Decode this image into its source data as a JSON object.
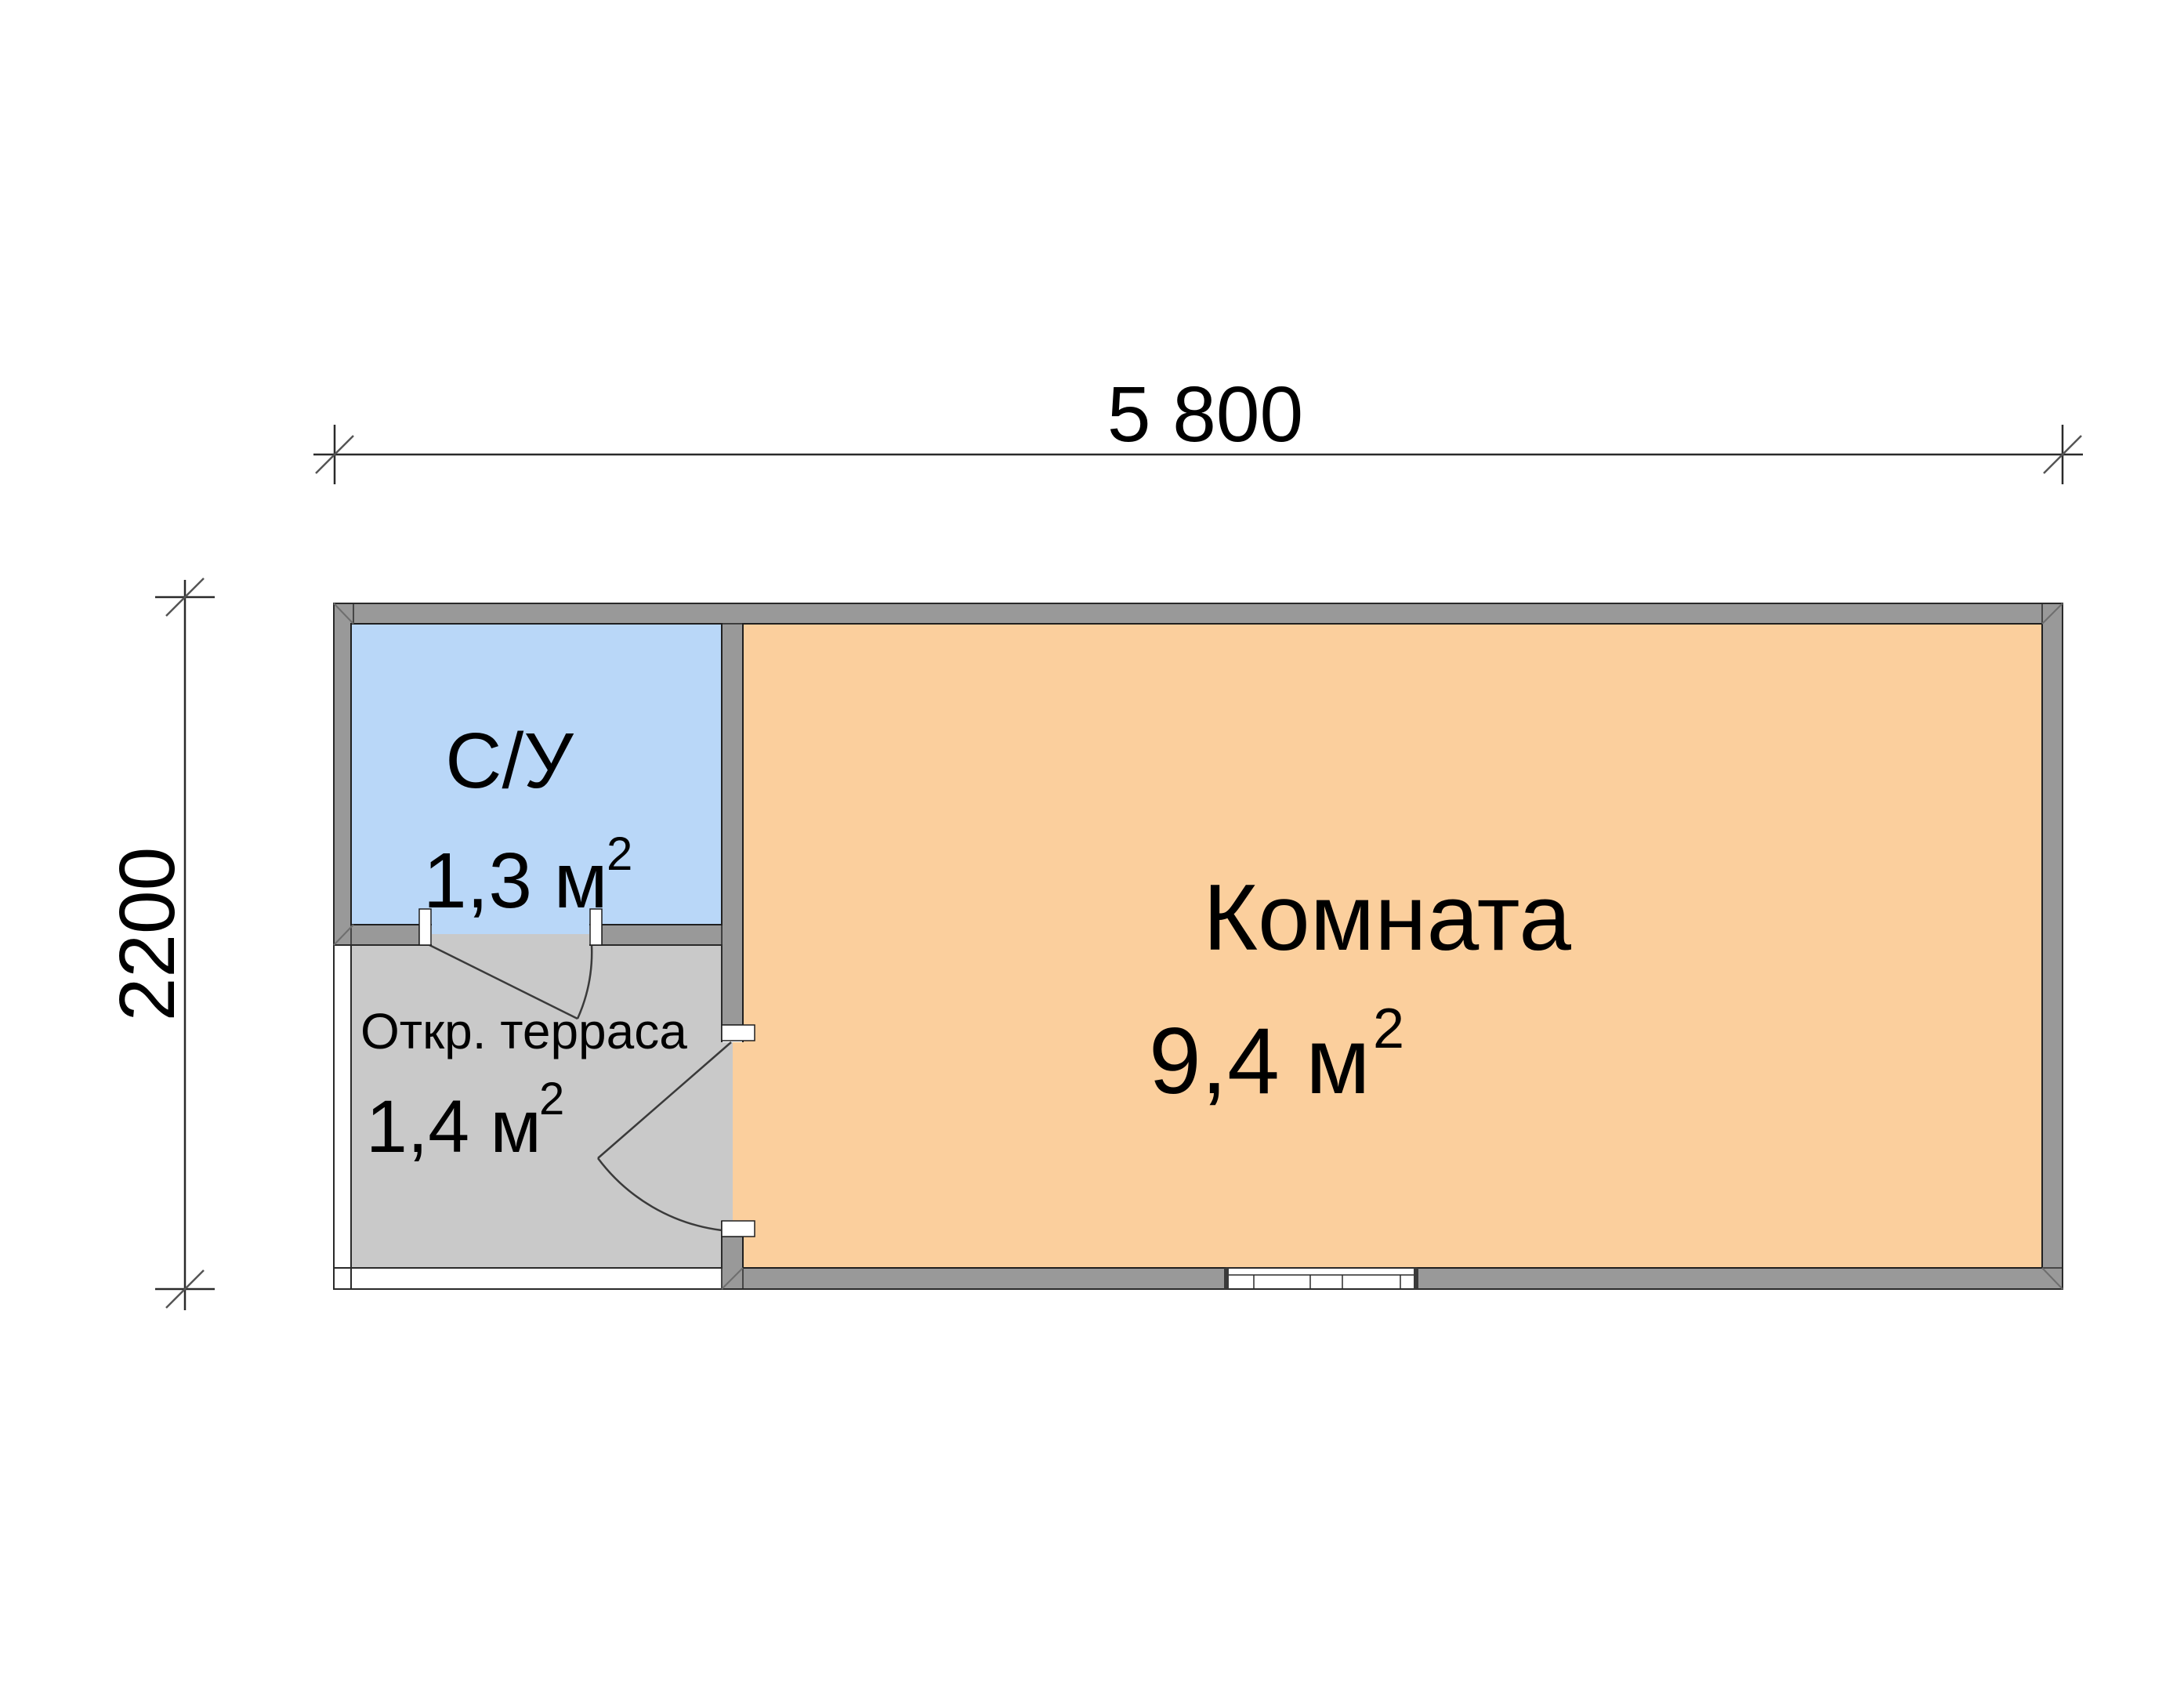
{
  "plan": {
    "dimensions": {
      "width_label": "5 800",
      "height_label": "2200"
    },
    "rooms": {
      "bathroom": {
        "name": "С/У",
        "area": "1,3 м",
        "sup": "2"
      },
      "living": {
        "name": "Комната",
        "area": "9,4 м",
        "sup": "2"
      },
      "terrace": {
        "name": "Откр. терраса",
        "area": "1,4 м",
        "sup": "2"
      }
    },
    "colors": {
      "wall": "#999999",
      "bathroom_fill": "#b9d7f8",
      "room_fill": "#fbcf9d",
      "terrace_fill": "#c9c9c9"
    }
  }
}
